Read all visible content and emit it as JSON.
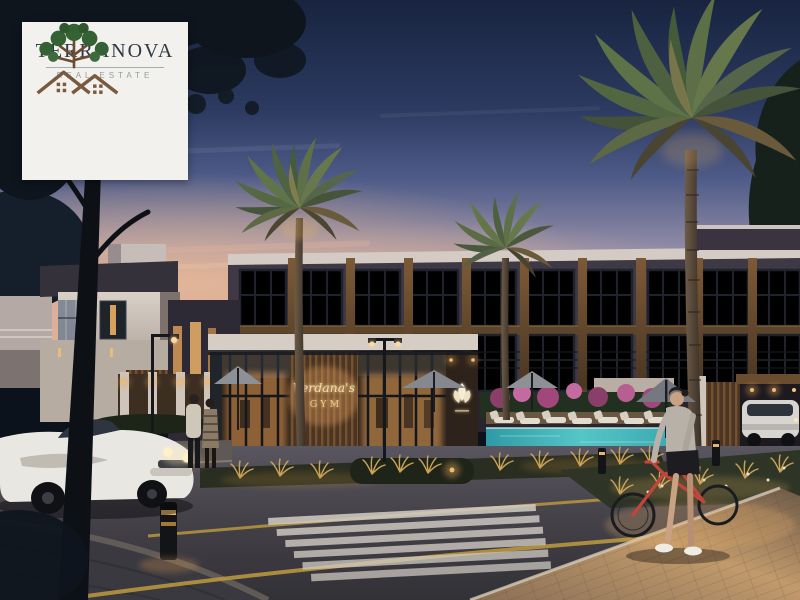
{
  "scene": {
    "type": "real-estate architectural render at dusk",
    "watermark_logo": {
      "brand": "TERRANOVA",
      "tagline": "REAL ESTATE"
    },
    "gym_sign": {
      "script_line": "Verdana's",
      "word_line": "GYM"
    },
    "depicted": [
      "twilight sky fading to pink horizon",
      "modern townhouses with warm lit floor-to-ceiling windows and wood piers",
      "white two-storey villa on the left",
      "single-storey gym clubhouse with wood-slat sign wall and glowing emblem",
      "swimming pool with white sun loungers and grey patio umbrellas",
      "bougainvillea and lit ornamental grasses",
      "three date palms and a dark conifer",
      "classic white convertible car on the road",
      "couple walking on the left sidewalk",
      "woman pushing a red bicycle on warm-lit paver sidewalk",
      "white SUV parked in a wooden carport",
      "zebra crosswalk with yellow road lines, street lamps and bollard lights",
      "dark foreground tree silhouette over the sky"
    ],
    "colors": {
      "sky_top": "#1b2744",
      "sky_mid": "#52608c",
      "horizon_pink": "#d9a893",
      "window_glow": "#eec27c",
      "wood": "#6e5138",
      "pool_water": "#45b7bd",
      "road": "#46454b",
      "paver_warm": "#c1996c",
      "bike_red": "#c2453c",
      "logo_green": "#3a6b3c",
      "logo_brown": "#7a5a3f",
      "logo_text": "#2d3944",
      "sign_gold": "#f0d49e"
    }
  }
}
